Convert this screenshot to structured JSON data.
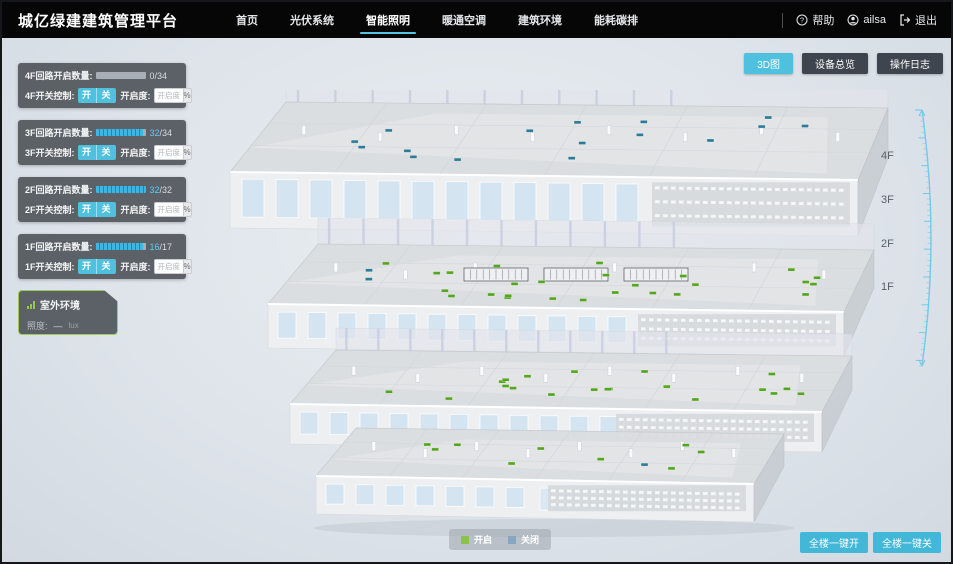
{
  "header": {
    "logo": "城亿绿建建筑管理平台",
    "nav": [
      {
        "label": "首页",
        "active": false
      },
      {
        "label": "光伏系统",
        "active": false
      },
      {
        "label": "智能照明",
        "active": true
      },
      {
        "label": "暖通空调",
        "active": false
      },
      {
        "label": "建筑环境",
        "active": false
      },
      {
        "label": "能耗碳排",
        "active": false
      }
    ],
    "help_label": "帮助",
    "user_name": "ailsa",
    "logout_label": "退出"
  },
  "view_buttons": [
    {
      "label": "3D图",
      "active": true
    },
    {
      "label": "设备总览",
      "active": false
    },
    {
      "label": "操作日志",
      "active": false
    }
  ],
  "controls": {
    "on_label": "开",
    "off_label": "关",
    "dim_label": "开启度:",
    "dim_placeholder": "开启度",
    "percent_label": "%"
  },
  "floor_panels": [
    {
      "floor": "4F",
      "count_label": "4F回路开启数量:",
      "count_open": "0",
      "count_total": "/34",
      "progress": 0,
      "control_label": "4F开关控制:"
    },
    {
      "floor": "3F",
      "count_label": "3F回路开启数量:",
      "count_open": "32",
      "count_total": "/34",
      "progress": 0.94,
      "control_label": "3F开关控制:"
    },
    {
      "floor": "2F",
      "count_label": "2F回路开启数量:",
      "count_open": "32",
      "count_total": "/32",
      "progress": 1,
      "control_label": "2F开关控制:"
    },
    {
      "floor": "1F",
      "count_label": "1F回路开启数量:",
      "count_open": "16",
      "count_total": "/17",
      "progress": 0.94,
      "control_label": "1F开关控制:"
    }
  ],
  "outdoor": {
    "title": "室外环境",
    "metric_label": "照度:",
    "metric_value": "—",
    "metric_unit": "lux"
  },
  "floor_labels": [
    "4F",
    "3F",
    "2F",
    "1F"
  ],
  "legend": {
    "on_label": "开启",
    "off_label": "关闭",
    "on_color": "#8bc34a",
    "off_color": "#85a7c3"
  },
  "bulk_buttons": [
    {
      "label": "全楼一键开"
    },
    {
      "label": "全楼一键关"
    }
  ],
  "building": {
    "floors": [
      {
        "name": "4F",
        "lights_on": 0,
        "lights_off": 16
      },
      {
        "name": "3F",
        "lights_on": 26,
        "lights_off": 2
      },
      {
        "name": "2F",
        "lights_on": 20,
        "lights_off": 0
      },
      {
        "name": "1F",
        "lights_on": 9,
        "lights_off": 1
      }
    ],
    "light_on_color": "#55a51f",
    "light_off_color": "#2e7b97"
  },
  "colors": {
    "accent": "#4fc0dd",
    "nav_underline": "#55c4e3",
    "panel_bg": "#4a4e54"
  }
}
